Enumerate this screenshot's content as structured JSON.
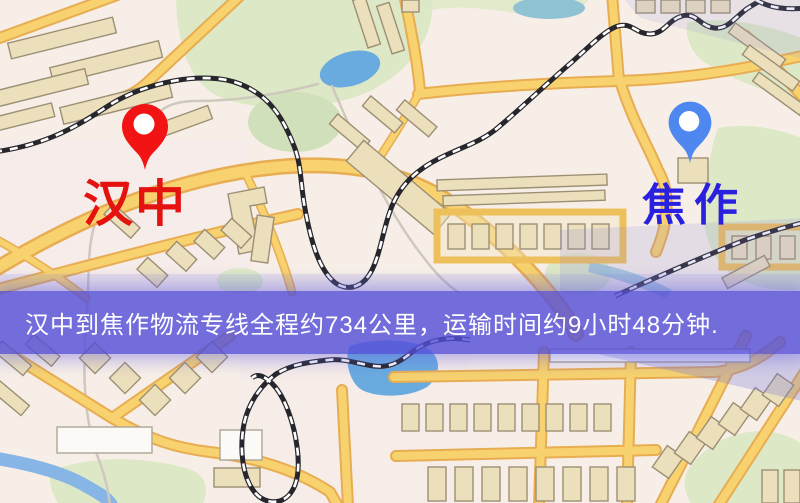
{
  "markers": {
    "origin": {
      "label": "汉中",
      "label_color": "#e41310",
      "pin_color": "#f21414"
    },
    "destination": {
      "label": "焦作",
      "label_color": "#2a20e0",
      "pin_color": "#4f87f0"
    }
  },
  "banner": {
    "text": "汉中到焦作物流专线全程约734公里，运输时间约9小时48分钟.",
    "background_color": "#564fd8",
    "text_color": "#ffffff"
  },
  "map": {
    "colors": {
      "background": "#f7efe7",
      "road_fill": "#f7d26e",
      "road_casing": "#e8ad52",
      "building": "#ebdfbc",
      "park": "#dde8c6",
      "water": "#6aabdf",
      "railway": "#26262c"
    }
  }
}
